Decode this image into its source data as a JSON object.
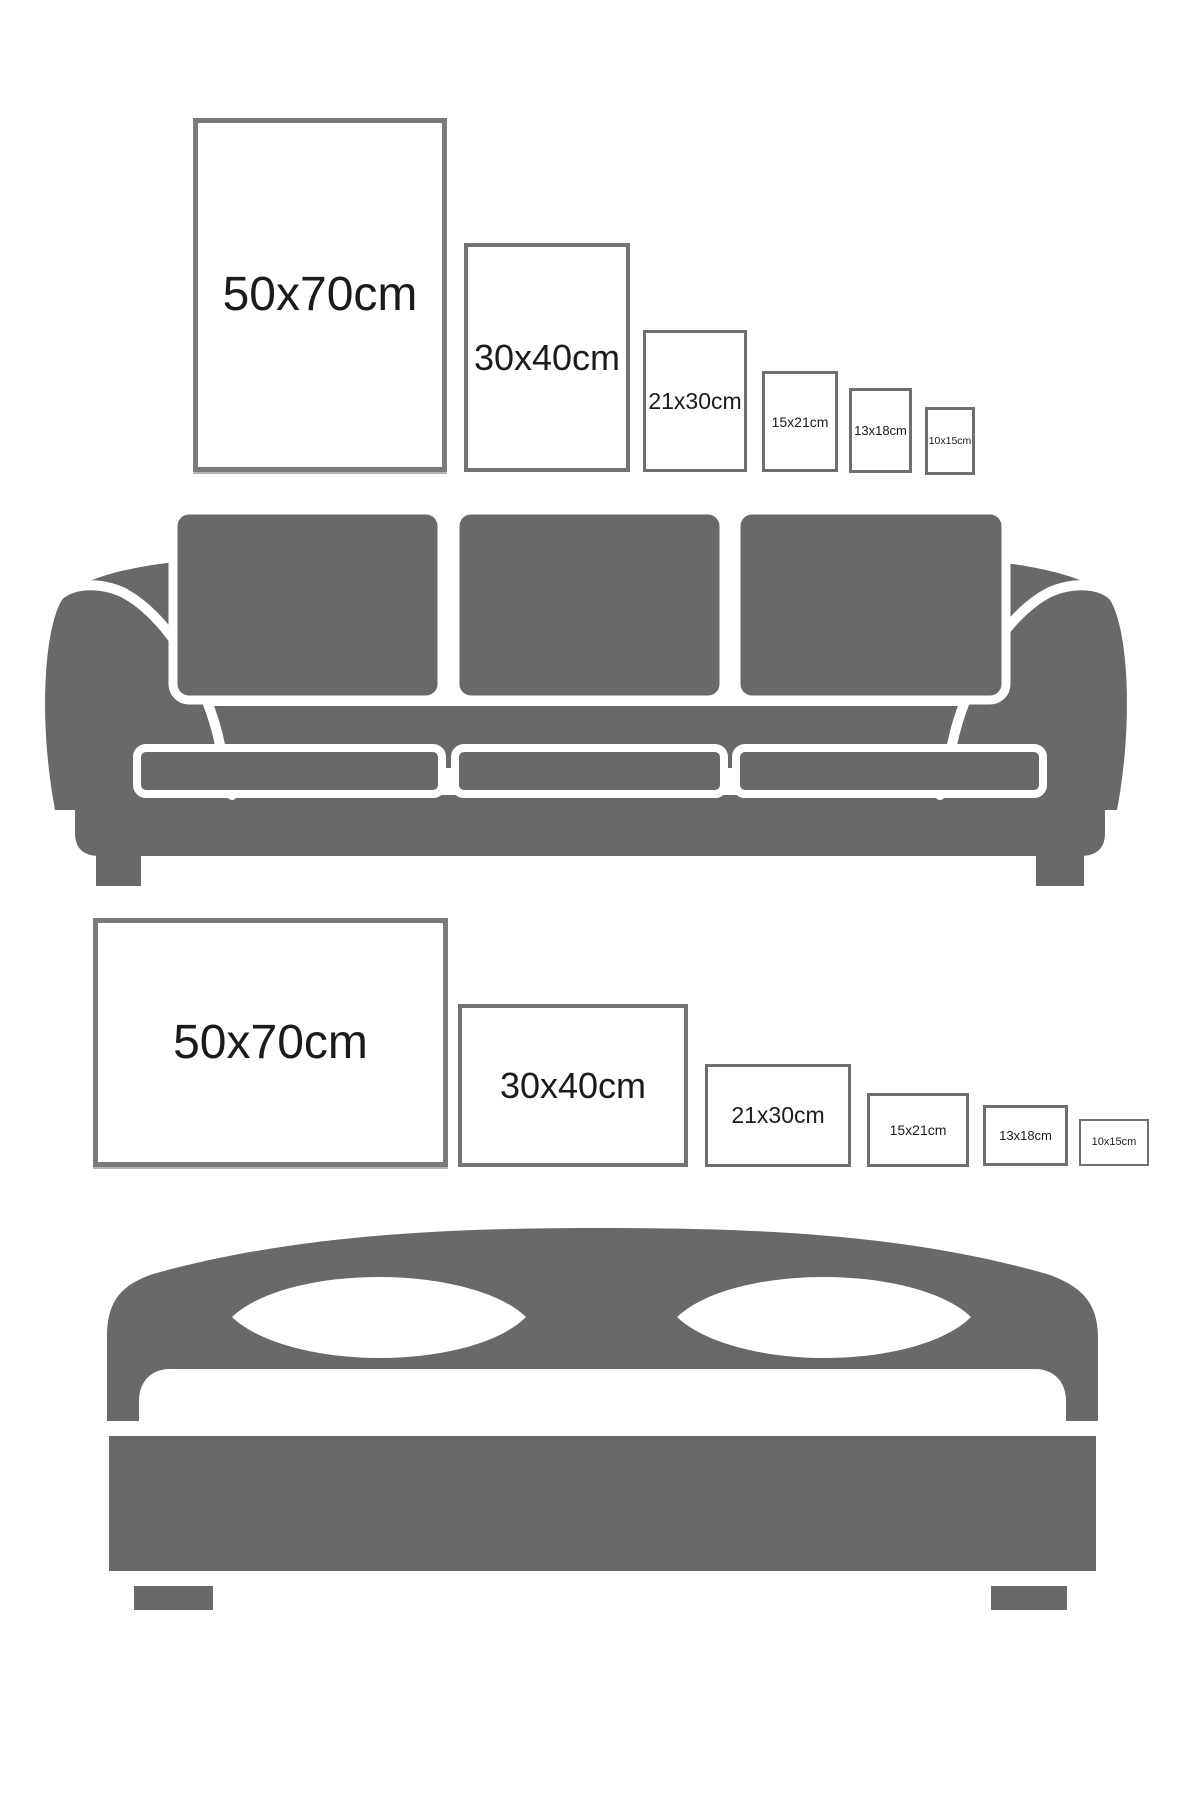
{
  "page": {
    "background": "#ffffff"
  },
  "colors": {
    "furniture_gray": "#69696b",
    "frame_border_large": "#7a7a7d",
    "frame_border_mid": "#737376",
    "frame_border_small": "#6f6f72",
    "label_text": "#1b1b1b"
  },
  "frame_rows": {
    "above_sofa": {
      "orientation": "portrait",
      "labels": [
        "50x70cm",
        "30x40cm",
        "21x30cm",
        "15x21cm",
        "13x18cm",
        "10x15cm"
      ]
    },
    "above_bed": {
      "orientation": "landscape",
      "labels": [
        "50x70cm",
        "30x40cm",
        "21x30cm",
        "15x21cm",
        "13x18cm",
        "10x15cm"
      ]
    }
  },
  "illustrations": {
    "sofa": "three-seat sofa silhouette",
    "bed": "double bed with two pillows silhouette"
  }
}
